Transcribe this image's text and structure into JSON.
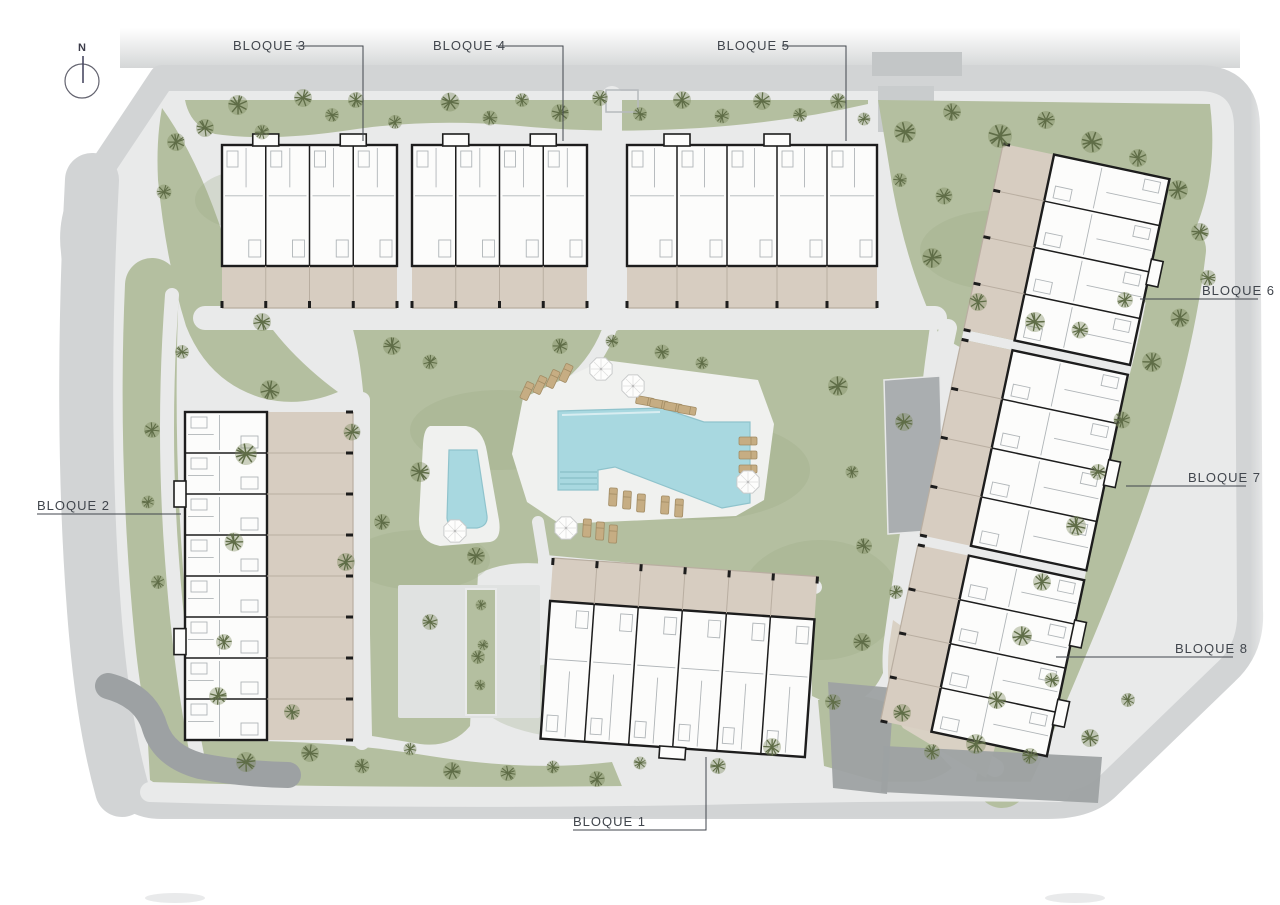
{
  "plan": {
    "compass": {
      "label": "N"
    },
    "labels": {
      "bloque1": "BLOQUE 1",
      "bloque2": "BLOQUE 2",
      "bloque3": "BLOQUE 3",
      "bloque4": "BLOQUE 4",
      "bloque5": "BLOQUE 5",
      "bloque6": "BLOQUE 6",
      "bloque7": "BLOQUE 7",
      "bloque8": "BLOQUE 8"
    }
  },
  "palette": {
    "page": "#ffffff",
    "road": "#d2d4d5",
    "road_dark": "#9da1a3",
    "path": "#e9eaea",
    "plaza": "#e0e2e1",
    "gray_mid": "#b7babb",
    "ramp": "#aaaeb0",
    "walk_tan": "#d9d1c4",
    "lawn": "#b4bfa0",
    "lawn_dark": "#9aa984",
    "tree": "#5f6d47",
    "tree_soft": "#7b8a5c",
    "wall": "#1d1d1d",
    "bfill": "#fcfcfb",
    "rline": "#b0b5b8",
    "terrace": "#d7cdc1",
    "tline": "#b9aea1",
    "deck": "#f0f1ef",
    "pool": "#a8d8e0",
    "pool_edge": "#8fc3cc",
    "lounger": "#c6ad83",
    "lounger_edge": "#a28c64",
    "label": "#41464d"
  }
}
